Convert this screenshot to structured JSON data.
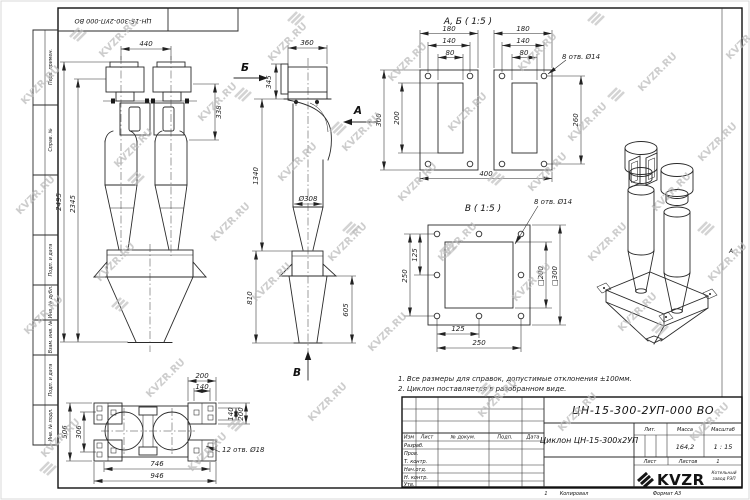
{
  "margin": {
    "labels": [
      "Перв. примен.",
      "Справ. №",
      "Подп. и дата",
      "Инв. № дубл.",
      "Взам. инв. №",
      "Подп. и дата",
      "Инв. № подл."
    ],
    "zone_letter": "А"
  },
  "header_strip": {
    "doc_number_inverted": "ЦН-15-300-2УП-000 ВО"
  },
  "notes": {
    "line1": "1. Все размеры для справок, допустимые отклонения ±100мм.",
    "line2": "2. Циклон поставляется в разобранном виде."
  },
  "views": {
    "front": {
      "d440": "440",
      "d338": "338",
      "d2495": "2495",
      "d2345": "2345"
    },
    "side": {
      "label_b": "Б",
      "label_a": "А",
      "label_v": "В",
      "d360": "360",
      "d345": "345",
      "d1340": "1340",
      "dia308": "Ø308",
      "d810": "810",
      "d605": "605"
    },
    "plan": {
      "d200_top": "200",
      "d140_top": "140",
      "d140_right": "140",
      "d200_right": "200",
      "d506": "506",
      "d306": "306",
      "d746": "746",
      "d946": "946",
      "holes_note": "12 отв. Ø18"
    },
    "section_ab": {
      "title": "А, Б ( 1:5 )",
      "d180_left": "180",
      "d180_right": "180",
      "d140_left": "140",
      "d140_right": "140",
      "d80_left": "80",
      "d80_right": "80",
      "d300": "300",
      "d200": "200",
      "d260": "260",
      "d400": "400",
      "holes_note": "8 отв. Ø14"
    },
    "section_v": {
      "title": "В ( 1:5 )",
      "d250_left": "250",
      "d125_left": "125",
      "d125_bottom": "125",
      "d250_bottom": "250",
      "d200_square": "□200",
      "d300_square": "□300",
      "holes_note": "8 отв. Ø14"
    }
  },
  "title_block": {
    "doc_number": "ЦН-15-300-2УП-000 ВО",
    "name": "Циклон ЦН-15-300х2УП",
    "columns": [
      "Изм",
      "Лист",
      "№ докум.",
      "Подп.",
      "Дата"
    ],
    "rows": [
      "Разраб.",
      "Пров.",
      "Т. контр.",
      "Нач.отд.",
      "Н. контр.",
      "Утв."
    ],
    "lit_label": "Лит.",
    "mass_label": "Масса",
    "scale_label": "Масштаб",
    "mass_value": "164,2",
    "scale_value": "1 : 15",
    "sheet_label": "Лист",
    "sheets_label": "Листов",
    "sheets_value": "1",
    "logo_text": "KVZR",
    "company_line1": "Котельный",
    "company_line2": "завод РЭП",
    "page_num": "1",
    "copier_label": "Копировал",
    "format_label": "Формат А3"
  },
  "watermark": {
    "text": "KVZR.RU"
  }
}
